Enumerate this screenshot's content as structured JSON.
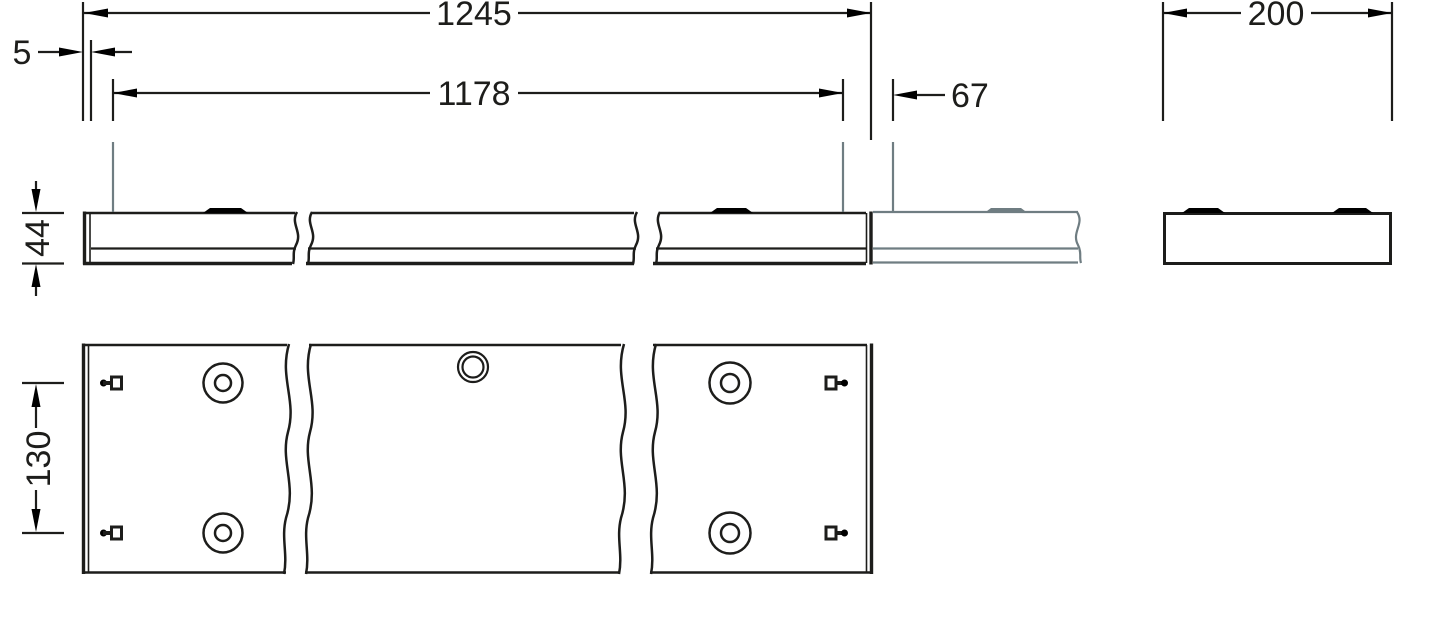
{
  "drawing": {
    "kind": "luminaire-dimension-drawing",
    "units": "mm",
    "dimensions": {
      "total_length": "1245",
      "end_gap": "5",
      "fixing_spacing": "1178",
      "row_joint_offset": "67",
      "housing_width": "200",
      "housing_height": "44",
      "mounting_hole_spacing": "130"
    }
  },
  "colors": {
    "background": "#ffffff",
    "line": "#1d1d1b",
    "ghost": "#6f7d82"
  }
}
